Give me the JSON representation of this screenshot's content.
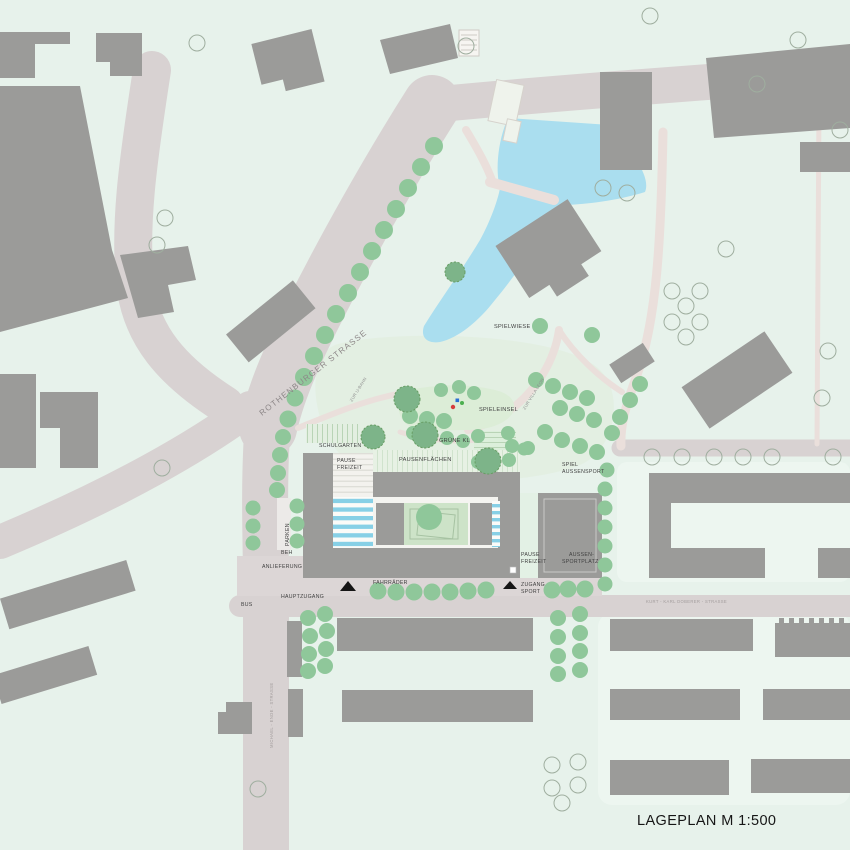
{
  "plan": {
    "title": "LAGEPLAN M 1:500"
  },
  "streets": {
    "rothenburger": "ROTHENBURGER STRASSE",
    "kurt_karl_doberer": "KURT - KARL DOBERER - STRASSE",
    "michael_ende": "MICHAEL - ENDE - STRASSE"
  },
  "wayfinding": {
    "zur_ubahn": "ZUR U-BAHN",
    "zur_villa_leon": "ZUR VILLA LEON",
    "hauptzugang": "HAUPTZUGANG",
    "zugang_sport_line1": "ZUGANG",
    "zugang_sport_line2": "SPORT",
    "bus": "BUS",
    "anlieferung": "ANLIEFERUNG",
    "beh": "BEH",
    "parken": "PARKEN",
    "fahrraeder": "FAHRRÄDER"
  },
  "areas": {
    "spielwiese": "SPIELWIESE",
    "spieleinsel": "SPIELEINSEL",
    "gruene_kl": "GRÜNE KL",
    "schulgarten": "SCHULGARTEN",
    "pausenflaechen": "PAUSENFLÄCHEN",
    "pause_line1": "PAUSE",
    "pause_line2": "FREIZEIT",
    "spiel_aussensport_line1": "SPIEL",
    "spiel_aussensport_line2": "AUSSENSPORT",
    "aussen_sportplatz_line1": "AUSSEN-",
    "aussen_sportplatz_line2": "SPORTPLATZ"
  },
  "colors": {
    "bg": "#e7f2eb",
    "street": "#d8d2d2",
    "path": "#eadfdb",
    "building": "#9b9b99",
    "water": "#aadeef",
    "tree": "#8fc79a",
    "tree_dark": "#7db489",
    "tree_outline": "#9fae9f",
    "stripe": "#87d0e6",
    "courtyard": "#cde3c8",
    "island": "#dcedd7",
    "plaza": "#dcd6d6",
    "residential": "#edf6f0",
    "label_dark": "#404040",
    "label_street": "#a39d9d",
    "label_street_big": "#8d8788",
    "arrow": "#151515",
    "marker_red": "#d63b3b",
    "marker_blue": "#2a6fd4",
    "marker_green": "#4caf50"
  }
}
